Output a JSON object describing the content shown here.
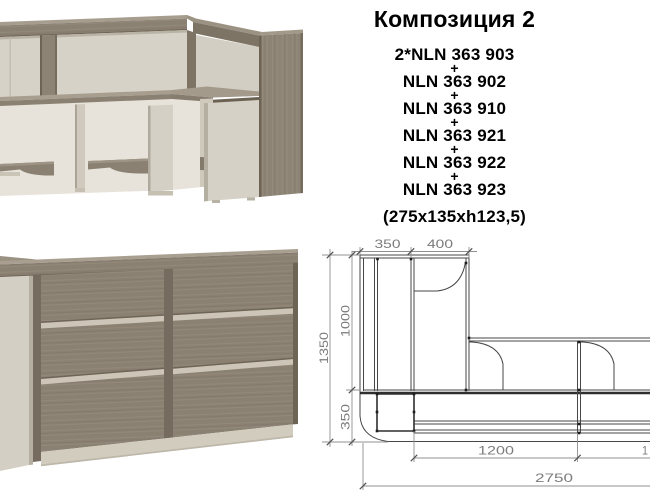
{
  "composition": {
    "title": "Композиция 2",
    "plus": "+",
    "items": [
      "2*NLN 363 903",
      "NLN 363 902",
      "NLN 363 910",
      "NLN 363 921",
      "NLN 363 922",
      "NLN 363 923"
    ],
    "overall_dimensions": "(275x135xh123,5)"
  },
  "plan": {
    "top": {
      "d1": "350",
      "d2": "400"
    },
    "left": {
      "outer": "1350",
      "inner_top": "1000",
      "inner_bottom": "350"
    },
    "bottom": {
      "d1": "1200",
      "d2_clipped": "1",
      "total": "2750"
    }
  },
  "images": {
    "back_view": "reception-desk-back-view",
    "front_view": "reception-desk-front-view",
    "plan_view": "reception-desk-plan-drawing"
  },
  "colors": {
    "background": "#ffffff",
    "text": "#000000",
    "wood_top": "#a39a8b",
    "wood_mid": "#8b8173",
    "wood_dark": "#6e6456",
    "panel_light": "#d6d1c6",
    "panel_shadow": "#b9b3a6",
    "plan_line": "#474747",
    "plan_dim_line": "#909090",
    "plan_dim_text": "#7c7c7c"
  }
}
